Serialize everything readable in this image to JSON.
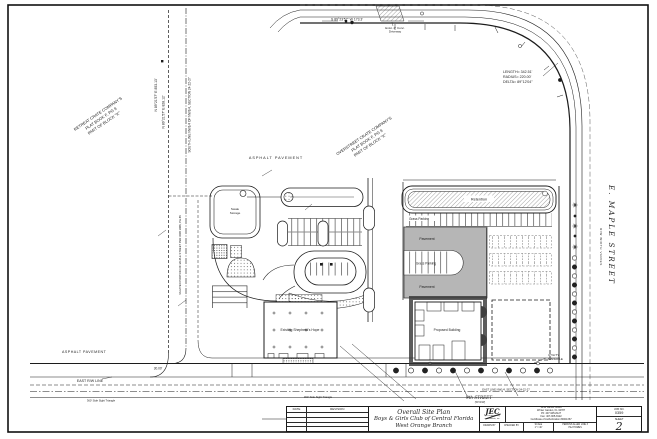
{
  "plan": {
    "bearings": {
      "north_dim": "S 89°23'57\" W  173.3'",
      "west_1": "N 89°21'57\" E  853.13'",
      "west_2": "N 89°21'57\" E  828.12'",
      "south_line_note": "SOUTH LINE NW1/4 OF NW1/4, SECTION 24-22-27",
      "vacated_note": "VACATED PORTION OF MAPLE STREET PER ORB 1866, PG 85",
      "east_line_note": "EAST LINE NW1/4, SECTION 24-22-27",
      "east_rw": "EAST R/W LINE",
      "dim_30": "30.00'"
    },
    "curve": {
      "length": "LENGTH= 342.51'",
      "radius": "RADIUS= 220.00'",
      "delta": "DELTA= 89°12'04\""
    },
    "streets": {
      "maple": "E. MAPLE STREET",
      "maple_rw": "R/W WIDTH VARIES",
      "south_street": "9th STREET",
      "south_street_rw": "(50' R/W)"
    },
    "plats": {
      "retreat": [
        "RETREAT CRATE COMPANY'S",
        "PLAT BOOK F, PG 9",
        "PART OF BLOCK \"K\""
      ],
      "overstreet": [
        "OVERSTREET CRATE COMPANY'S",
        "PLAT BOOK F, PG 9",
        "PART OF BLOCK \"K\""
      ]
    },
    "areas": {
      "asphalt_top": "ASPHALT PAVEMENT",
      "asphalt_left": "ASPHALT PAVEMENT",
      "retention": "Retention",
      "grass_parking_top": "Grass Parking",
      "grass_parking_mid": "Grass Parking",
      "pavement_1": "Pavement",
      "pavement_2": "Pavement",
      "storage_l1": "Swale",
      "storage_l2": "Storage",
      "existing_building": "Existing Shepherd's Hope",
      "proposed_building": "Proposed Building",
      "utility_l1": "UTILITY",
      "utility_l2": "MANHOLE",
      "driveway_l1": "Exist. 4\" Conc.",
      "driveway_l2": "Driveway",
      "sight_triangle": "360' Side Sight Triangle"
    }
  },
  "title_block": {
    "rev": {
      "date": "DATE",
      "revision": "REVISION"
    },
    "title": [
      "Overall Site Plan",
      "Boys & Girls Club of Central Florida",
      "West Orange Branch"
    ],
    "firm": {
      "logo": "JEC",
      "name": "jec engineering consultants, inc.",
      "addr1": "1218 James Street",
      "addr2": "Winter Garden, FL 34787",
      "phone": "Ph: 407-905-8127",
      "fax": "Fax: 407-905-8122",
      "cert": "Certificate of Authorization #0001367"
    },
    "fields": {
      "drawn": "DRAWN BY",
      "checked": "CHECKED BY",
      "scale": "SCALE",
      "scale_val": "1\" = 40'",
      "client_l1": "PERKINS ALLEN LINE 3",
      "client_l2": "P&J HOMES"
    },
    "job": {
      "label": "JOB NO.",
      "number": "0359",
      "sheet_label": "SHEET",
      "sheet_number": "2"
    }
  }
}
